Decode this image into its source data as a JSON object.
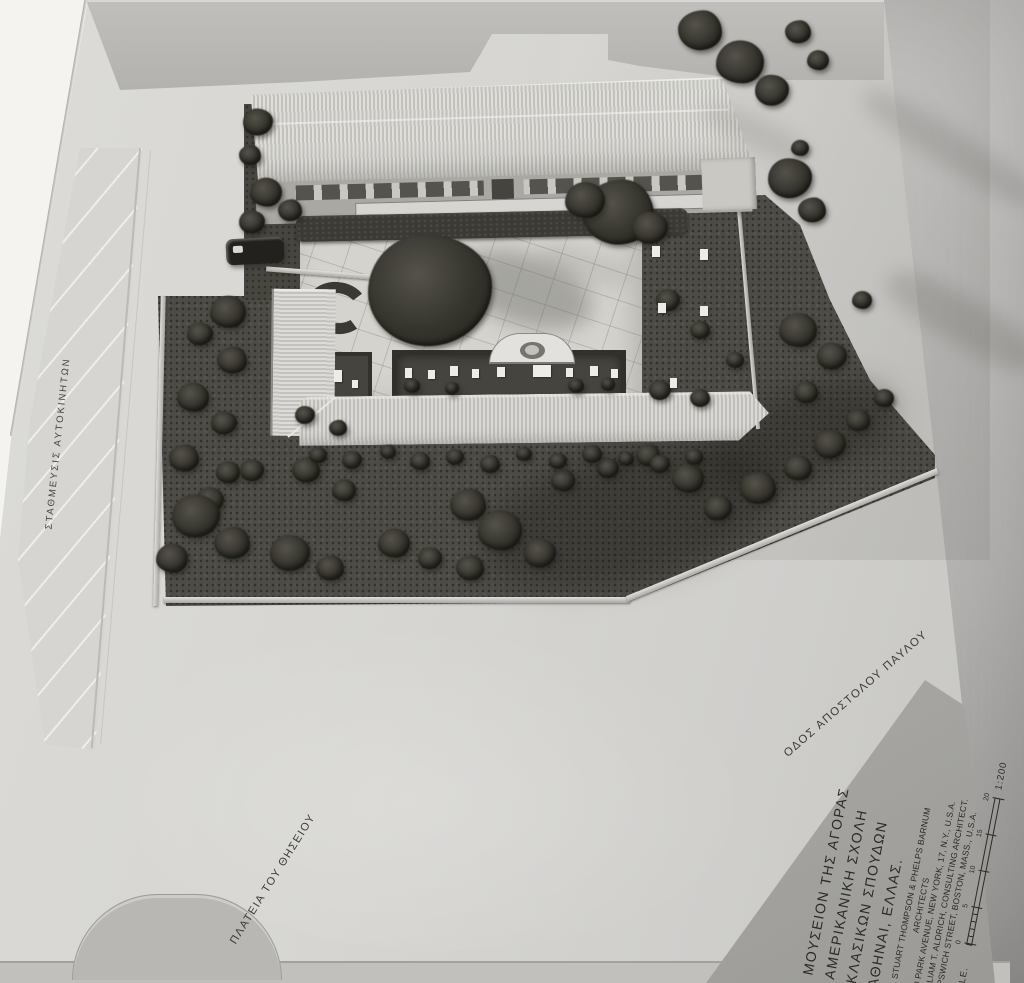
{
  "labels": {
    "parking": "ΣΤΑΘΜΕΥΣΙΣ ΑΥΤΟΚΙΝΗΤΩΝ",
    "square": "ΠΛΑΤΕΙΑ ΤΟΥ ΘΗΣΕΙΟΥ",
    "street": "ΟΔΟΣ ΑΠΟΣΤΟΛΟΥ ΠΑΥΛΟΥ"
  },
  "title_block": {
    "project": [
      "ΜΟΥΣΕΙΟΝ ΤΗΣ ΑΓΟΡΑΣ",
      "ΑΜΕΡΙΚΑΝΙΚΗ ΣΧΟΛΗ",
      "ΚΛΑΣΙΚΩΝ ΣΠΟΥΔΩΝ",
      "ΑΘΗΝΑΙ, ΕΛΛΑΣ."
    ],
    "architects": [
      "W. STUART THOMPSON & PHELPS BARNUM",
      "ARCHITECTS",
      "250 PARK AVENUE, NEW YORK, 17, N.Y., U.S.A.",
      "WILLIAM T. ALDRICH, CONSULTING ARCHITECT.",
      "30 IPSWICH STREET, BOSTON, MASS., U.S.A."
    ],
    "scale_label": "SCALE.",
    "scale_ticks": [
      "0",
      "5",
      "10",
      "15",
      "20"
    ],
    "scale_ratio": "1:200"
  },
  "colors": {
    "paper_white": "#f4f3f0",
    "backdrop_gray": "#c7c6c4",
    "board_gray": "#d7d6d2",
    "terrain_gray": "#b6b5b2",
    "garden_dark": "#4d4c46",
    "ink": "#2b2a26"
  }
}
